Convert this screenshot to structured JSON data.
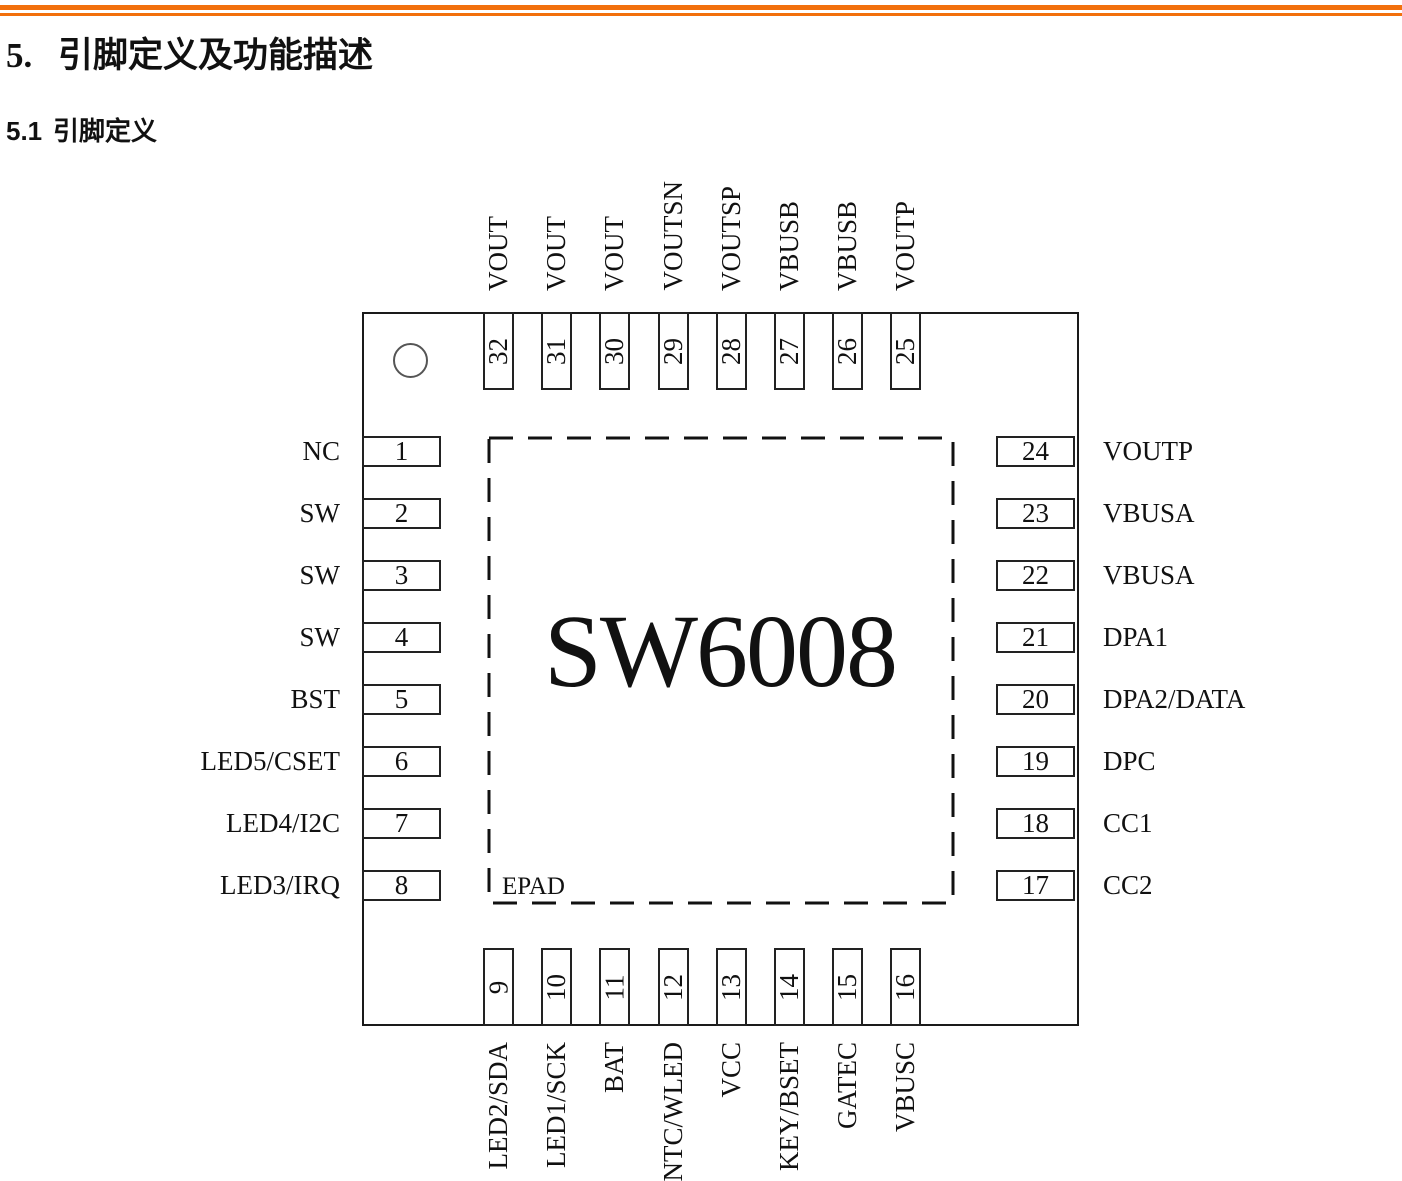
{
  "page": {
    "accent_color": "#f2700c",
    "h1": {
      "number": "5.",
      "text": "引脚定义及功能描述"
    },
    "h2": {
      "number": "5.1",
      "text": "引脚定义"
    }
  },
  "chip": {
    "name": "SW6008",
    "epad_label": "EPAD",
    "pins": {
      "top": [
        {
          "num": "32",
          "label": "VOUT"
        },
        {
          "num": "31",
          "label": "VOUT"
        },
        {
          "num": "30",
          "label": "VOUT"
        },
        {
          "num": "29",
          "label": "VOUTSN"
        },
        {
          "num": "28",
          "label": "VOUTSP"
        },
        {
          "num": "27",
          "label": "VBUSB"
        },
        {
          "num": "26",
          "label": "VBUSB"
        },
        {
          "num": "25",
          "label": "VOUTP"
        }
      ],
      "left": [
        {
          "num": "1",
          "label": "NC"
        },
        {
          "num": "2",
          "label": "SW"
        },
        {
          "num": "3",
          "label": "SW"
        },
        {
          "num": "4",
          "label": "SW"
        },
        {
          "num": "5",
          "label": "BST"
        },
        {
          "num": "6",
          "label": "LED5/CSET"
        },
        {
          "num": "7",
          "label": "LED4/I2C"
        },
        {
          "num": "8",
          "label": "LED3/IRQ"
        }
      ],
      "right": [
        {
          "num": "24",
          "label": "VOUTP"
        },
        {
          "num": "23",
          "label": "VBUSA"
        },
        {
          "num": "22",
          "label": "VBUSA"
        },
        {
          "num": "21",
          "label": "DPA1"
        },
        {
          "num": "20",
          "label": "DPA2/DATA"
        },
        {
          "num": "19",
          "label": "DPC"
        },
        {
          "num": "18",
          "label": "CC1"
        },
        {
          "num": "17",
          "label": "CC2"
        }
      ],
      "bottom": [
        {
          "num": "9",
          "label": "LED2/SDA"
        },
        {
          "num": "10",
          "label": "LED1/SCK"
        },
        {
          "num": "11",
          "label": "BAT"
        },
        {
          "num": "12",
          "label": "NTC/WLED"
        },
        {
          "num": "13",
          "label": "VCC"
        },
        {
          "num": "14",
          "label": "KEY/BSET"
        },
        {
          "num": "15",
          "label": "GATEC"
        },
        {
          "num": "16",
          "label": "VBUSC"
        }
      ]
    }
  }
}
